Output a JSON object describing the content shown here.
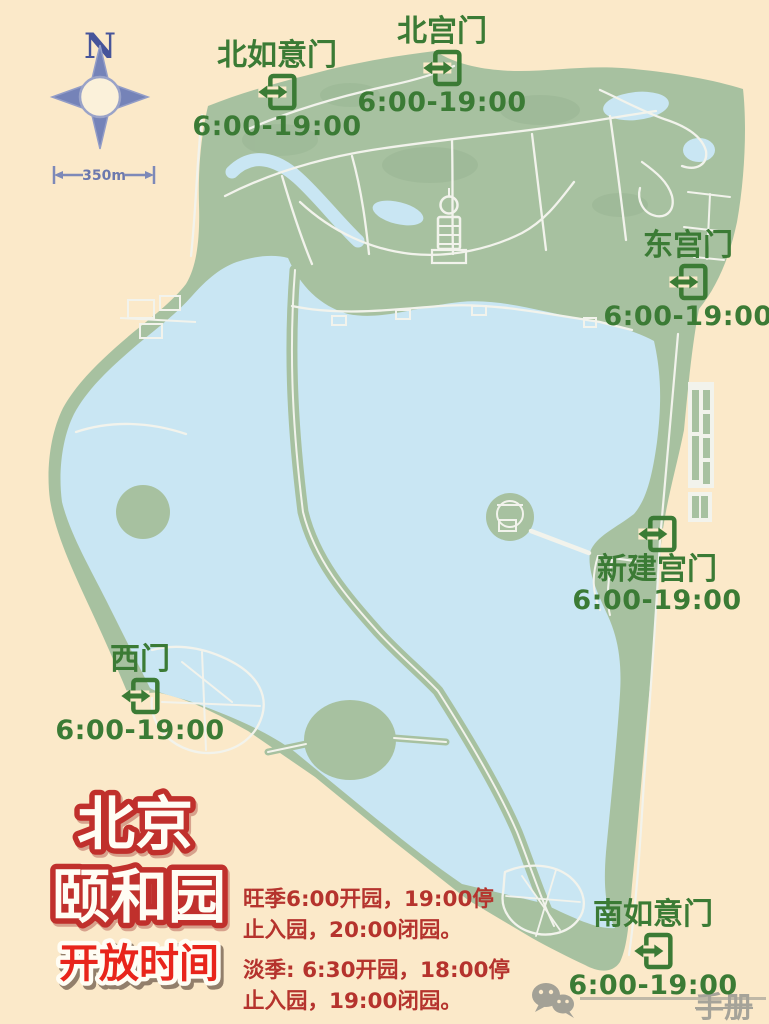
{
  "poster": {
    "kind": "park-opening-hours-map"
  },
  "compass": {
    "label": "N"
  },
  "scale_bar": {
    "label": "350m"
  },
  "gates": [
    {
      "name": "北如意门",
      "hours": "6:00-19:00"
    },
    {
      "name": "北宫门",
      "hours": "6:00-19:00"
    },
    {
      "name": "东宫门",
      "hours": "6:00-19:00"
    },
    {
      "name": "新建宫门",
      "hours": "6:00-19:00"
    },
    {
      "name": "西门",
      "hours": "6:00-19:00"
    },
    {
      "name": "南如意门",
      "hours": "6:00-19:00"
    }
  ],
  "title": {
    "city": "北京",
    "park": "颐和园",
    "subtitle": "开放时间"
  },
  "opening_hours": {
    "peak_season": "旺季6:00开园，19:00停止入园，20:00闭园。",
    "off_season": "淡季: 6:30开园，18:00停止入园，19:00闭园。"
  },
  "watermark": {
    "icon": "wechat-icon",
    "visible_text": "手册"
  },
  "colors": {
    "background": "#fbe9c9",
    "land": "#a7c1a0",
    "water": "#c9e6f3",
    "path": "#f2f3ec",
    "gate_green": "#3b7b35",
    "season_red": "#b5332d",
    "title_outline_red": "#c0302c",
    "subtitle_red": "#e8251b",
    "compass_blue": "#7583b8",
    "watermark_gray": "#a5a399"
  }
}
